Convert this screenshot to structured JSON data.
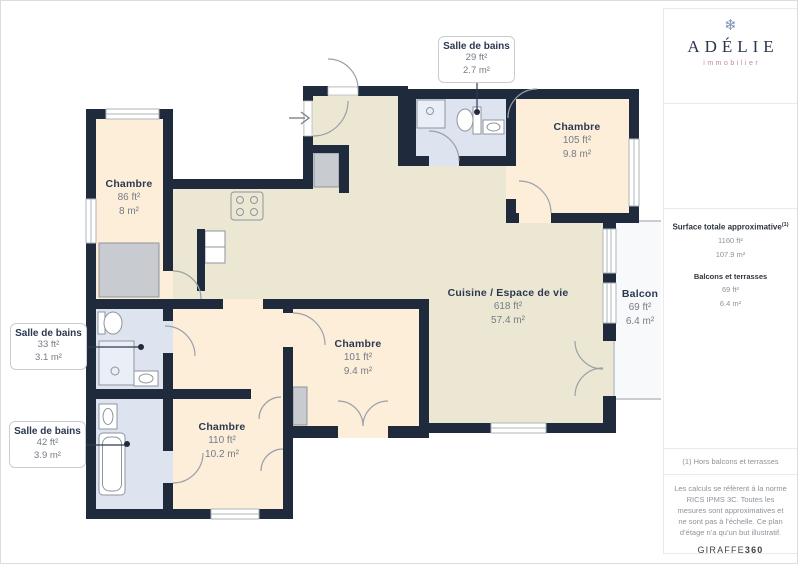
{
  "sidebar": {
    "brand": {
      "icon": "snowflake-icon",
      "name": "ADÉLIE",
      "tagline": "immobilier"
    },
    "summary": {
      "title": "Surface totale approximative",
      "title_sup": "(1)",
      "total_ft": "1160 ft²",
      "total_m": "107.9 m²",
      "sub_label": "Balcons et terrasses",
      "sub_ft": "69 ft²",
      "sub_m": "6.4 m²"
    },
    "footnote": "(1) Hors balcons et terrasses",
    "disclaimer": "Les calculs se réfèrent à la norme RICS IPMS 3C. Toutes les mesures sont approximatives et ne sont pas à l’échelle. Ce plan d’étage n’a qu’un but illustratif.",
    "watermark_normal": "GIRAFFE",
    "watermark_bold": "360"
  },
  "plan": {
    "rooms": {
      "bedroom_tl": {
        "name": "Chambre",
        "ft": "86 ft²",
        "m": "8 m²"
      },
      "bedroom_tr": {
        "name": "Chambre",
        "ft": "105 ft²",
        "m": "9.8 m²"
      },
      "living": {
        "name": "Cuisine / Espace de vie",
        "ft": "618 ft²",
        "m": "57.4 m²"
      },
      "bedroom_mid": {
        "name": "Chambre",
        "ft": "101 ft²",
        "m": "9.4 m²"
      },
      "bedroom_bottom": {
        "name": "Chambre",
        "ft": "110 ft²",
        "m": "10.2 m²"
      },
      "balcony": {
        "name": "Balcon",
        "ft": "69 ft²",
        "m": "6.4 m²"
      }
    },
    "callouts": {
      "bath_top": {
        "name": "Salle de bains",
        "ft": "29 ft²",
        "m": "2.7 m²"
      },
      "bath_left": {
        "name": "Salle de bains",
        "ft": "33 ft²",
        "m": "3.1 m²"
      },
      "bath_bottom_left": {
        "name": "Salle de bains",
        "ft": "42 ft²",
        "m": "3.9 m²"
      }
    },
    "colors": {
      "wall": "#1f2b3d",
      "bedroom_floor": "#fdeeda",
      "living_floor": "#ebe7d3",
      "bath_floor": "#dee4ef",
      "balcony_floor": "#f8f9fb"
    }
  }
}
